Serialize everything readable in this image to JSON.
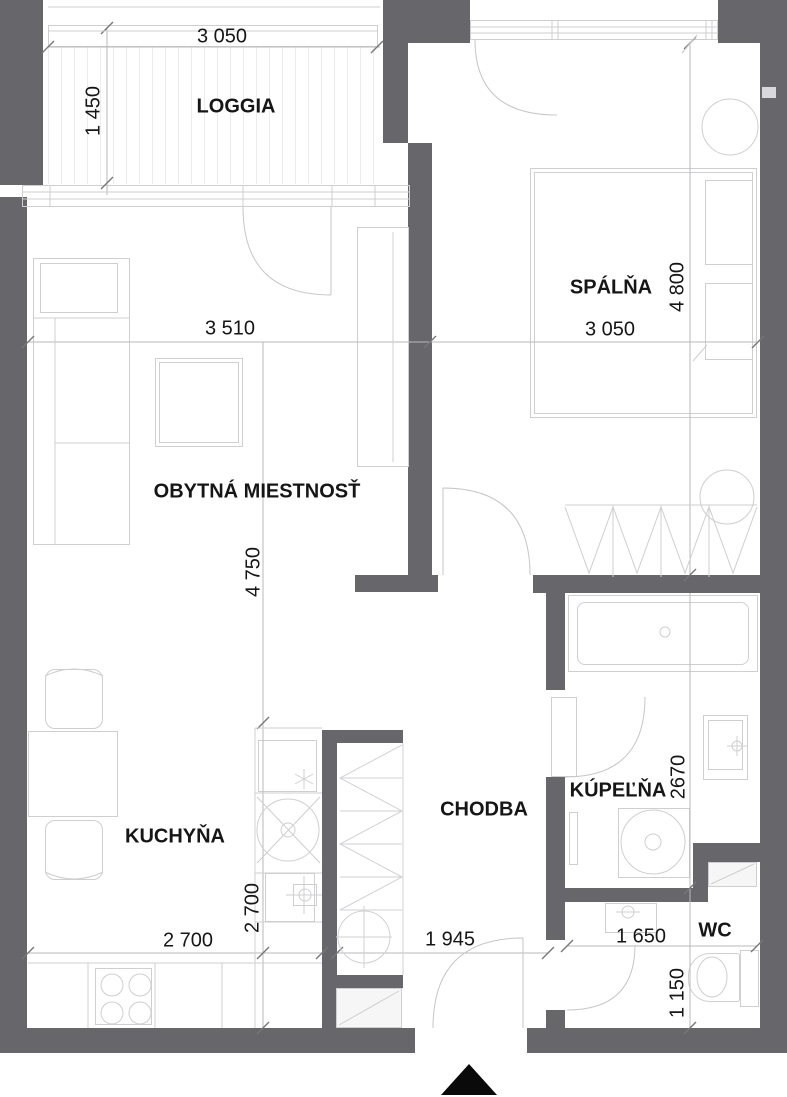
{
  "drawing": {
    "type": "apartment-floor-plan",
    "language": "Slovak",
    "colors": {
      "wall": "#67676b",
      "furniture_line": "#cfcfd2",
      "dimension_line": "#b9b9bc",
      "text": "#161616",
      "entrance_marker": "#0a0a0a",
      "background": "#ffffff"
    }
  },
  "rooms": {
    "loggia": {
      "label": "LOGGIA",
      "width": "3 050",
      "height": "1 450"
    },
    "living": {
      "label": "OBYTNÁ MIESTNOSŤ",
      "width": "3 510",
      "height": "4 750"
    },
    "bedroom": {
      "label": "SPÁLŇA",
      "width": "3 050",
      "height": "4 800"
    },
    "kitchen": {
      "label": "KUCHYŇA",
      "width": "2 700",
      "height": "2 700"
    },
    "hall": {
      "label": "CHODBA",
      "width": "1 945"
    },
    "bath": {
      "label": "KÚPEĽŇA",
      "height": "2670"
    },
    "wc": {
      "label": "WC",
      "width": "1 650",
      "height": "1 150"
    }
  },
  "marker": {
    "entrance": "entrance-triangle"
  }
}
